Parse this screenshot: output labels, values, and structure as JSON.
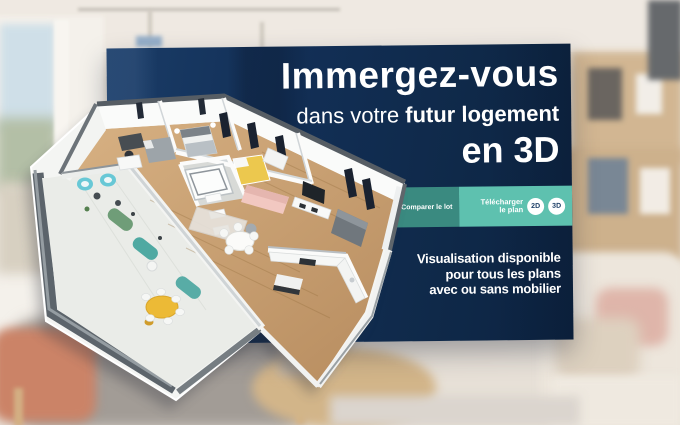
{
  "banner": {
    "headline": "Immergez-vous",
    "subheadline": {
      "regular": "dans votre",
      "bold": "futur logement"
    },
    "headline_3d": "en 3D",
    "tagline": {
      "line1": "Visualisation disponible",
      "line2": "pour tous les plans",
      "line3": "avec ou sans mobilier"
    },
    "colors": {
      "navy": "#122f56",
      "teal_dark": "#3a8a80",
      "teal_light": "#5ec1af",
      "text": "#ffffff"
    }
  },
  "toolbar": {
    "compare_label": "Comparer le lot",
    "checkbox_icon": "checkbox-unchecked",
    "download_label_line1": "Télécharger",
    "download_label_line2": "le plan",
    "button_2d": "2D",
    "button_3d": "3D"
  },
  "floorplan": {
    "type": "3d-isometric-apartment-plan",
    "accent_colors": {
      "wood_floor": "#c9a172",
      "terrace_floor": "#eaece8",
      "yellow_table": "#ecba36",
      "teal_chairs": "#4fa9a2",
      "pink_sofa": "#f2c8c1",
      "yellow_bed": "#ecc84e"
    }
  }
}
